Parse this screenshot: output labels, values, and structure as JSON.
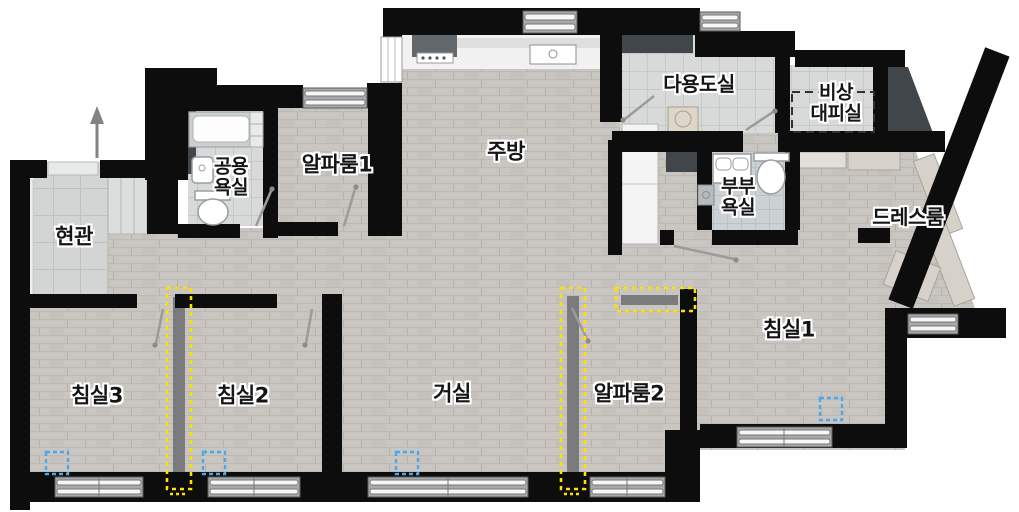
{
  "colors": {
    "wall": "#0d0d0d",
    "wood_floor": "#c9c6c2",
    "tile_floor": "#d8dada",
    "duct": "#41464b",
    "partition_gray": "#7b7b7b",
    "highlight_yellow": "#ffdf00",
    "marker_blue": "#4aa7ee",
    "label_text": "#151515",
    "label_outline": "#ffffff"
  },
  "rooms": {
    "entrance": {
      "label": "현관"
    },
    "bath_common": {
      "label": "공용\n욕실"
    },
    "alpha1": {
      "label": "알파룸1"
    },
    "kitchen": {
      "label": "주방"
    },
    "utility": {
      "label": "다용도실"
    },
    "shelter": {
      "label": "비상\n대피실"
    },
    "bath_master": {
      "label": "부부\n욕실"
    },
    "dress": {
      "label": "드레스룸"
    },
    "bed1": {
      "label": "침실1"
    },
    "bed2": {
      "label": "침실2"
    },
    "bed3": {
      "label": "침실3"
    },
    "living": {
      "label": "거실"
    },
    "alpha2": {
      "label": "알파룸2"
    }
  },
  "annotations": {
    "yellow_partition_markers": 3,
    "blue_square_markers": 4,
    "shelter_dashed_outline": 1,
    "entrance_direction_arrow": "up"
  }
}
